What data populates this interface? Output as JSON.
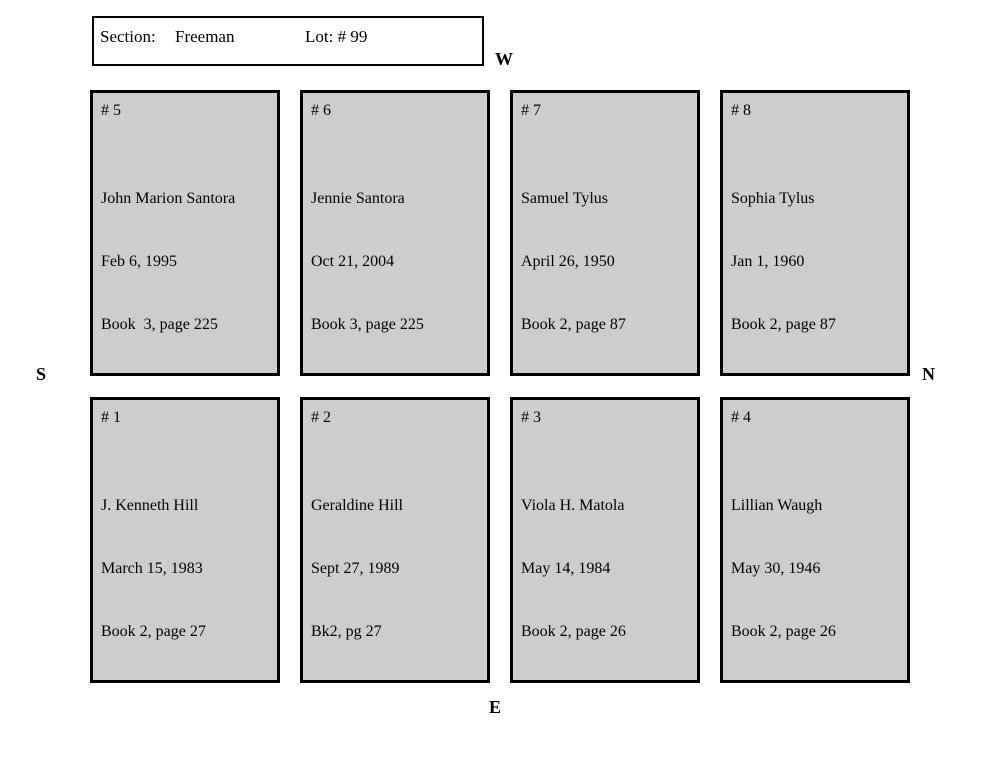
{
  "header": {
    "section_label": "Section:",
    "section_value": "Freeman",
    "lot_label": "Lot: # 99"
  },
  "compass": {
    "west": "W",
    "south": "S",
    "north": "N",
    "east": "E"
  },
  "colors": {
    "plot_fill": "#cdcdcd",
    "border": "#000000",
    "background": "#ffffff"
  },
  "plots": [
    {
      "number": "# 5",
      "name": "John Marion Santora",
      "date": "Feb 6, 1995",
      "book": "Book  3, page 225"
    },
    {
      "number": "# 6",
      "name": "Jennie Santora",
      "date": "Oct 21, 2004",
      "book": "Book 3, page 225"
    },
    {
      "number": "# 7",
      "name": "Samuel Tylus",
      "date": "April 26, 1950",
      "book": "Book 2, page 87"
    },
    {
      "number": "# 8",
      "name": "Sophia Tylus",
      "date": "Jan 1, 1960",
      "book": "Book 2, page 87"
    },
    {
      "number": "# 1",
      "name": "J. Kenneth Hill",
      "date": "March 15, 1983",
      "book": "Book 2, page 27"
    },
    {
      "number": "# 2",
      "name": "Geraldine Hill",
      "date": "Sept 27, 1989",
      "book": "Bk2, pg 27"
    },
    {
      "number": "# 3",
      "name": "Viola H. Matola",
      "date": "May 14, 1984",
      "book": "Book 2, page 26"
    },
    {
      "number": "# 4",
      "name": "Lillian Waugh",
      "date": "May 30, 1946",
      "book": "Book 2, page 26"
    }
  ]
}
